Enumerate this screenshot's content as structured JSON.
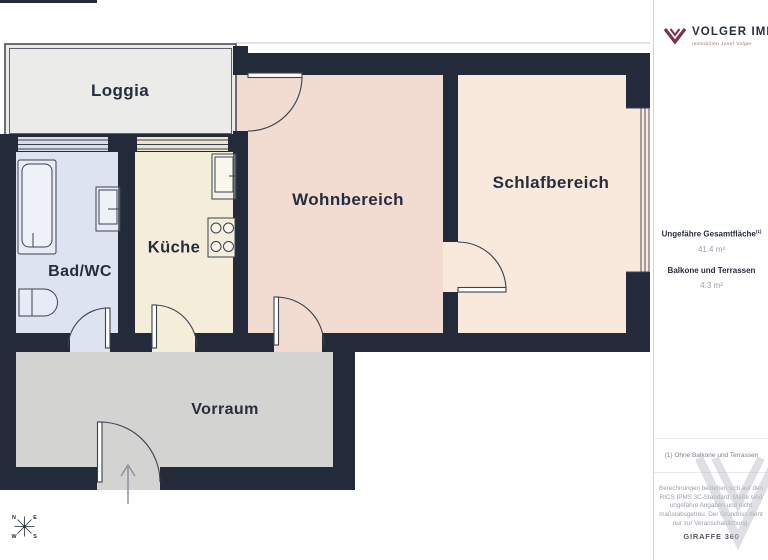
{
  "floorplan": {
    "rooms": [
      {
        "id": "loggia",
        "label": "Loggia"
      },
      {
        "id": "bad_wc",
        "label": "Bad/WC"
      },
      {
        "id": "kueche",
        "label": "Küche"
      },
      {
        "id": "wohnbereich",
        "label": "Wohnbereich"
      },
      {
        "id": "schlafbereich",
        "label": "Schlafbereich"
      },
      {
        "id": "vorraum",
        "label": "Vorraum"
      }
    ],
    "fixtures": [
      "bathtub",
      "washbasin",
      "toilet",
      "kitchen-sink",
      "stove",
      "entrance-arrow"
    ],
    "compass": {
      "n": "N",
      "e": "E",
      "s": "S",
      "w": "W"
    }
  },
  "sidebar": {
    "brand": {
      "name": "VOLGER IMMO",
      "tagline": "Immobilien Josef Volger"
    },
    "areas": [
      {
        "label": "Ungefähre Gesamtfläche",
        "footnote_ref": "(1)",
        "value": "41.4 m²"
      },
      {
        "label": "Balkone und Terrassen",
        "footnote_ref": "",
        "value": "4.3 m²"
      }
    ],
    "footnote": "(1) Ohne Balkone und Terrassen",
    "disclaimer": "Berechnungen beziehen sich auf den RICS IPMS 3C-Standard. Maße sind ungefähre Angaben und nicht maßstabsgetreu. Der Grundriss dient nur zur Veranschaulichung.",
    "scan_brand": "GIRAFFE 360"
  },
  "colors": {
    "wall": "#232a39",
    "brand_accent": "#7d3344",
    "loggia_fill": "#ebebe9",
    "bad_wc_fill": "#dee3f1",
    "kueche_fill": "#f4edda",
    "wohnbereich_fill": "#f2dcd2",
    "schlafbereich_fill": "#f9e9dc",
    "vorraum_fill": "#d3d3d1"
  }
}
